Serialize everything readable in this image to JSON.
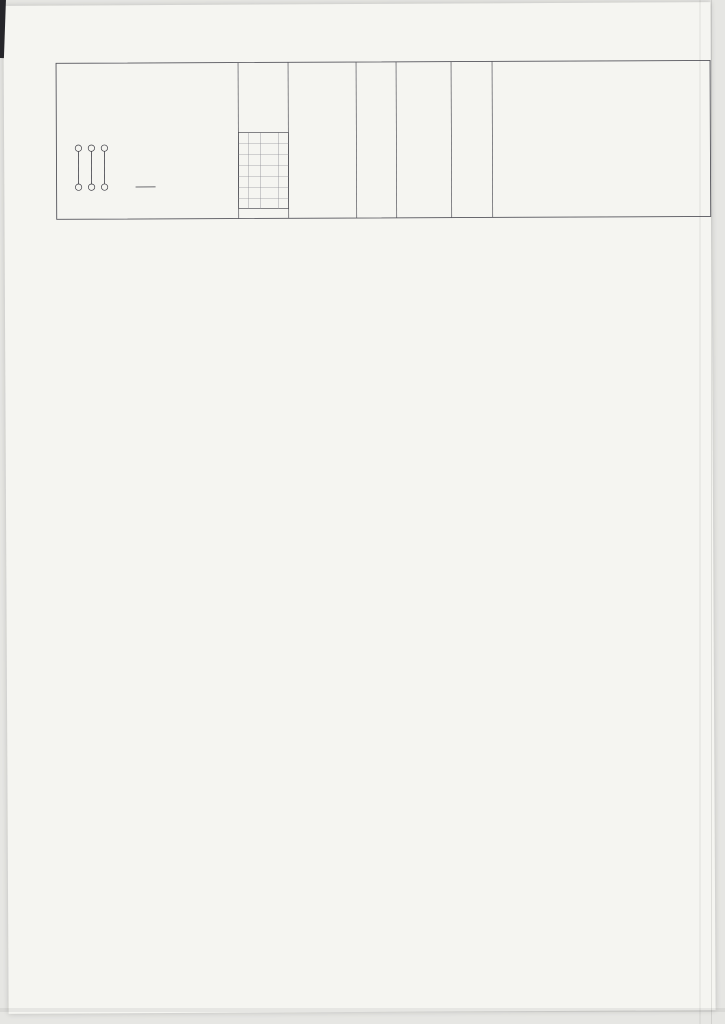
{
  "scan": {
    "paper": "#f5f5f1",
    "margin": "#e6e6e3",
    "ink": "#3f3f46",
    "dark": "#2f2f36",
    "light": "#8b8b92"
  },
  "sheet": {
    "legend": {
      "items": [
        "TOP CHORD MEMBER",
        "BOTTOM CHORD MEMBER",
        "WEB MEMBER"
      ],
      "indicator": "PURLIN POSITION INDICATOR",
      "notes": [
        "NOTE :",
        "ALL DIMENSIONS ARE IN MM",
        "TUBE SIZES AS PER DESIGN",
        "NODES : FORGED STEEL"
      ],
      "rev_headers": [
        "REV",
        "DATE",
        "DESCRIPTION",
        "BY"
      ]
    },
    "parties": {
      "owner_label": "Owner",
      "pm_label": "Project Manager",
      "consultant_label": "CONSULTANT",
      "contractor_label": "CONTRACTOR",
      "contractor_note": "AL RASHID",
      "owner_logo_text": "الخطوط الجوية العربية السعودية",
      "pm_logo_text": "شركة تطوير المباني"
    },
    "company": {
      "name": "Rafid Steel Industries",
      "subtitle": "RAFID SPACE FRAME LTD. CO.",
      "address": "RIYADH - SAUDI ARABIA",
      "project_label": "PROJECT TITLE :",
      "drawing_title": "SPACE FRAME GEOMETRIC LAYOUT REFERENCE DRAWING",
      "fields": [
        {
          "label": "DRAWN",
          "value": "—"
        },
        {
          "label": "DATE",
          "value": "—"
        },
        {
          "label": "CHECKED",
          "value": "—"
        },
        {
          "label": "SCALE",
          "value": "AS SHOWN"
        }
      ],
      "project_no_label": "PROJECT NO / DRAWING NO.",
      "project_no": "JRL.13 023 14/03",
      "revision": "0",
      "consultant_box": "CONSULTANT",
      "approvals": [
        {
          "code": "A",
          "text": "approved"
        },
        {
          "code": "B",
          "text": "approved as noted"
        },
        {
          "code": "C",
          "text": "rejected"
        }
      ],
      "sign_labels": [
        "Proj.Manager",
        "Signature"
      ]
    },
    "plan": {
      "title": "P L A N",
      "scale": "SCALE  1 : 200",
      "subtitle": "SPACE FRAME PURLIN REFERENCE DRAWING",
      "col_bubbles": [
        "6",
        "5",
        "4",
        "3",
        "2",
        "1"
      ],
      "row_bubbles": [
        "H",
        "G",
        "F",
        "E",
        "D",
        "C",
        "B",
        "A"
      ],
      "top_dims": [
        "1950",
        "9000",
        "5000",
        "6500",
        "5000",
        "9000",
        "1950"
      ],
      "top_total": "38400",
      "bottom_dims": [
        "1950",
        "9000",
        "5000",
        "6500",
        "5000",
        "9000",
        "1950"
      ],
      "bottom_subtotals": [
        "10950",
        "16500",
        "10950"
      ],
      "left_dims": [
        "7200",
        "7200",
        "7200",
        "7200",
        "2925",
        "2925",
        "4050"
      ],
      "section_marker": "A"
    },
    "section_a": {
      "title": "SECTION  A - A",
      "bubbles": [
        "H",
        "G",
        "F",
        "E",
        "D",
        "C",
        "B",
        "A"
      ]
    },
    "section_b": {
      "title": "SECTION  B - B",
      "bubbles": [
        "6",
        "5",
        "4",
        "3",
        "2",
        "1"
      ],
      "dims": [
        "9000",
        "5000",
        "6500",
        "5000",
        "9000",
        "1950"
      ]
    },
    "detail": {
      "title": "DETAIL - 1",
      "labels": {
        "weather": "WEATHER STRIP AT 600 CTRS",
        "gutter": "GUTTER",
        "wall": "BLOCK WALL BY OTHERS",
        "anchor": "HILTI ANCHOR BOLTS (TYP.)",
        "node": "S. F. NODE",
        "member": "S. F. MEMBER",
        "support": "S. F. SUPPORT",
        "panel": "SANDWICH PANEL 70 MM ROOF PANEL"
      }
    }
  }
}
